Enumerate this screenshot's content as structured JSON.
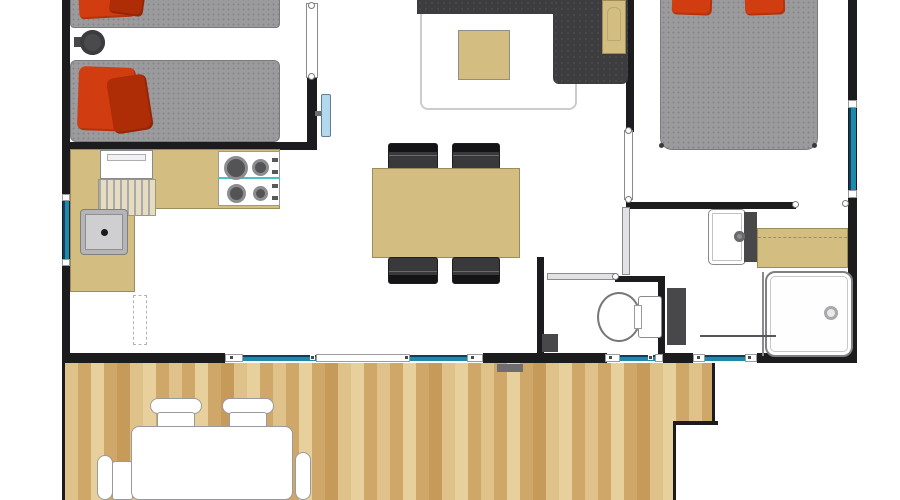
{
  "meta": {
    "title": "Mobile home / chalet floor plan, top view, with wooden terrace",
    "type": "architectural-floor-plan",
    "text_on_image": "none"
  },
  "palette": {
    "wall": "#1c1c1e",
    "mattress": "#9b9b9d",
    "mattressEdge": "#7a7a7d",
    "mattressDot": "#86868a",
    "pillow": "#d23c11",
    "pillowDark": "#ae2c06",
    "sofa": "#3d3d3f",
    "sofaDot": "#4a4a4c",
    "tan": "#d3bd81",
    "tanEdge": "#9b8c5c",
    "wood1": "#dfc28a",
    "wood2": "#cfa768",
    "wood3": "#e8d09c",
    "wood4": "#c69b59",
    "glass": "#1e89ad",
    "glassEdge": "#0f3f5e",
    "tv": "#b5d9ec",
    "sinkGray": "#b5b5b7",
    "sinkLight": "#cfcfd1",
    "dark": "#48484a",
    "rugEdge": "#cccccc",
    "fixtureEdge": "#8a8a8c",
    "mat": "#6e6e70"
  },
  "rooms": [
    {
      "id": "twin-bedroom",
      "name": "Twin bedroom (top left)",
      "furniture": [
        "single bed 1 with red cushions",
        "single bed 2 with red cushions",
        "round bedside stool"
      ]
    },
    {
      "id": "kitchen",
      "name": "Kitchen (left)",
      "furniture": [
        "L-shaped worktop",
        "refrigerator",
        "draining board",
        "sink",
        "4-burner gas hob"
      ]
    },
    {
      "id": "living-dining",
      "name": "Living / dining room (centre)",
      "furniture": [
        "corner sofa",
        "coffee table",
        "rug",
        "dining table",
        "four dining chairs",
        "wall-mounted TV",
        "side console"
      ]
    },
    {
      "id": "master-bedroom",
      "name": "Master bedroom (top right)",
      "furniture": [
        "double bed with two red cushions"
      ]
    },
    {
      "id": "shower-room",
      "name": "Shower room (bottom right)",
      "furniture": [
        "washbasin with dark vanity panel",
        "worktop",
        "shower cubicle with drain",
        "water heater",
        "towel rail"
      ]
    },
    {
      "id": "wc",
      "name": "Separate WC (bottom centre)",
      "furniture": [
        "toilet with cistern",
        "waste bin"
      ]
    },
    {
      "id": "terrace",
      "name": "Wooden terrace / deck (bottom)",
      "furniture": [
        "garden table",
        "four garden chairs",
        "doormat"
      ]
    }
  ],
  "openings": {
    "doors": [
      "twin bedroom door",
      "master bedroom door",
      "shower room door",
      "WC door",
      "kitchen entrance door (dashed swing)",
      "sliding patio door"
    ],
    "windows": [
      "left wall window",
      "right wall window",
      "patio glazing panes",
      "window under WC",
      "window under shower room"
    ]
  }
}
